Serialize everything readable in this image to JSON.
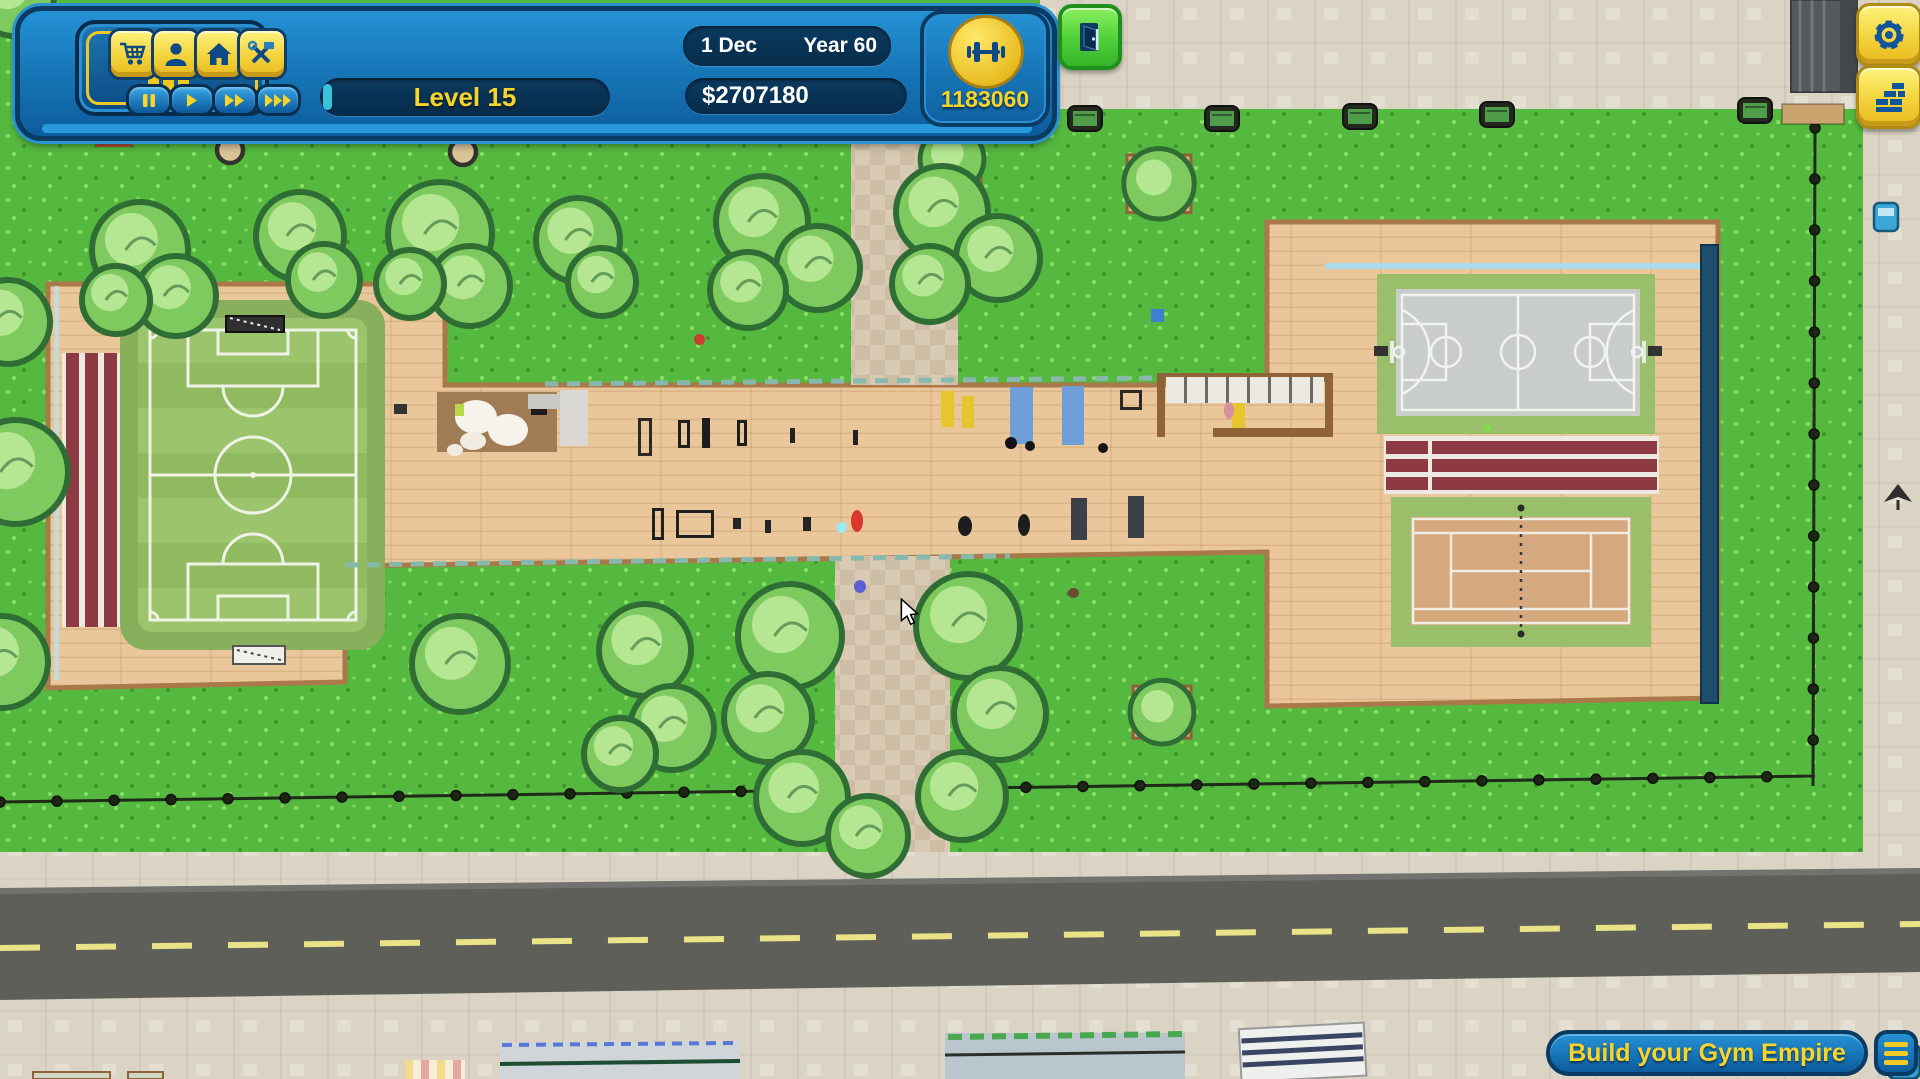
{
  "window": {
    "width": 1920,
    "height": 1079,
    "app": "gym-tycoon-game"
  },
  "colors": {
    "accent_yellow": "#f8d42a",
    "hud_blue": "#1573b4",
    "hud_border": "#0a3c63",
    "grass": "#52b53c",
    "path_tan": "#e9c79a",
    "path_border": "#aa7849",
    "plaza": "#dbd4c4",
    "road": "#5f5f5a",
    "road_line": "#e9e388",
    "field_green": "#9cc46d",
    "court_gray": "#c9cdc9",
    "tennis_clay": "#d6a87e",
    "sport_green": "#9abf6a",
    "track_maroon": "#8e3a42",
    "tree_green": "#7fca5e",
    "tree_outline": "#2f6d35",
    "wall_blue": "#1f4e6e",
    "exit_green": "#4ecf38"
  },
  "hud": {
    "stats_button": {
      "icon": "bar-chart-growth"
    },
    "toolbar": {
      "shop": {
        "icon": "shopping-cart"
      },
      "members": {
        "icon": "person"
      },
      "home": {
        "icon": "home"
      },
      "build": {
        "icon": "hammer-wrench"
      }
    },
    "speed": {
      "pause": {
        "icon": "pause"
      },
      "play": {
        "icon": "play"
      },
      "fast": {
        "icon": "fast-forward-2"
      },
      "fastest": {
        "icon": "fast-forward-3"
      }
    },
    "rating": {
      "stars": 5,
      "max": 5
    },
    "level": {
      "label": "Level 15"
    },
    "calendar": {
      "day": "1 Dec",
      "year": "Year 60"
    },
    "money": {
      "balance": "$2707180"
    },
    "gym_points": {
      "icon": "dumbbell",
      "value": "1183060"
    },
    "exit_button": {
      "icon": "open-door"
    },
    "settings_button": {
      "icon": "gear"
    },
    "walls_button": {
      "icon": "brick-wall"
    },
    "footer": {
      "title": "Build your Gym Empire",
      "menu": {
        "icon": "hamburger-menu"
      }
    }
  },
  "scene": {
    "facilities": [
      "soccer field",
      "running track",
      "outdoor gym strip",
      "spa room",
      "basketball court",
      "bleachers",
      "tennis court",
      "park paths",
      "perimeter fence",
      "road"
    ],
    "trees": [
      [
        14,
        -4,
        40
      ],
      [
        140,
        250,
        48
      ],
      [
        176,
        296,
        40
      ],
      [
        116,
        300,
        34
      ],
      [
        300,
        236,
        44
      ],
      [
        324,
        280,
        36
      ],
      [
        440,
        234,
        52
      ],
      [
        470,
        286,
        40
      ],
      [
        410,
        284,
        34
      ],
      [
        578,
        240,
        42
      ],
      [
        602,
        282,
        34
      ],
      [
        762,
        222,
        46
      ],
      [
        818,
        268,
        42
      ],
      [
        748,
        290,
        38
      ],
      [
        942,
        212,
        46
      ],
      [
        998,
        258,
        42
      ],
      [
        930,
        284,
        38
      ],
      [
        8,
        322,
        42
      ],
      [
        16,
        472,
        52
      ],
      [
        2,
        662,
        46
      ],
      [
        460,
        664,
        48
      ],
      [
        645,
        650,
        46
      ],
      [
        672,
        728,
        42
      ],
      [
        620,
        754,
        36
      ],
      [
        790,
        636,
        52
      ],
      [
        768,
        718,
        44
      ],
      [
        802,
        798,
        46
      ],
      [
        968,
        626,
        52
      ],
      [
        1000,
        714,
        46
      ],
      [
        962,
        796,
        44
      ],
      [
        868,
        836,
        40
      ]
    ],
    "planter_trees": [
      [
        1127,
        155,
        64
      ],
      [
        923,
        133,
        58
      ],
      [
        1133,
        686,
        58
      ]
    ],
    "park_benches": [
      [
        1068,
        106
      ],
      [
        1205,
        106
      ],
      [
        1343,
        104
      ],
      [
        1480,
        102
      ],
      [
        1738,
        98
      ]
    ],
    "wells": [
      [
        230,
        150
      ],
      [
        463,
        152
      ]
    ],
    "gym_equipment": [
      {
        "name": "spa-floor",
        "x": 437,
        "y": 392,
        "w": 120,
        "h": 60,
        "color": "#a07c55"
      },
      {
        "name": "spa-steam-1",
        "x": 455,
        "y": 400,
        "w": 42,
        "h": 34,
        "color": "#f6f3ec",
        "shape": "blob"
      },
      {
        "name": "spa-steam-2",
        "x": 488,
        "y": 414,
        "w": 40,
        "h": 32,
        "color": "#f6f3ec",
        "shape": "blob"
      },
      {
        "name": "spa-steam-3",
        "x": 460,
        "y": 432,
        "w": 26,
        "h": 18,
        "color": "#f0ece1",
        "shape": "blob"
      },
      {
        "name": "spa-steam-4",
        "x": 447,
        "y": 444,
        "w": 16,
        "h": 12,
        "color": "#f0ece1",
        "shape": "blob"
      },
      {
        "name": "spa-item",
        "x": 531,
        "y": 402,
        "w": 16,
        "h": 13,
        "color": "#1c1c1c"
      },
      {
        "name": "spa-plant",
        "x": 455,
        "y": 404,
        "w": 9,
        "h": 12,
        "color": "#b8d84a"
      },
      {
        "name": "gray-mat",
        "x": 528,
        "y": 394,
        "w": 34,
        "h": 15,
        "color": "#c9c9c4"
      },
      {
        "name": "gray-wall",
        "x": 560,
        "y": 390,
        "w": 28,
        "h": 56,
        "color": "#d9d8d3"
      },
      {
        "name": "wall-ladder",
        "x": 638,
        "y": 418,
        "w": 14,
        "h": 38,
        "color": "#2c2824",
        "hollow": true
      },
      {
        "name": "squat-rack-1",
        "x": 678,
        "y": 420,
        "w": 12,
        "h": 28,
        "color": "#1d1d1d",
        "hollow": true
      },
      {
        "name": "squat-rack-2",
        "x": 702,
        "y": 418,
        "w": 8,
        "h": 30,
        "color": "#1d1d1d"
      },
      {
        "name": "squat-rack-3",
        "x": 737,
        "y": 420,
        "w": 10,
        "h": 26,
        "color": "#1d1d1d",
        "hollow": true
      },
      {
        "name": "post-1",
        "x": 790,
        "y": 428,
        "w": 5,
        "h": 15,
        "color": "#222222"
      },
      {
        "name": "post-2",
        "x": 853,
        "y": 430,
        "w": 5,
        "h": 15,
        "color": "#222222"
      },
      {
        "name": "red-ball",
        "x": 694,
        "y": 334,
        "w": 11,
        "h": 11,
        "color": "#cc3b2f",
        "shape": "blob"
      },
      {
        "name": "blue-box",
        "x": 1151,
        "y": 309,
        "w": 13,
        "h": 13,
        "color": "#3f7fd0"
      },
      {
        "name": "yellow-mat-1",
        "x": 941,
        "y": 391,
        "w": 13,
        "h": 36,
        "color": "#e6c52f"
      },
      {
        "name": "yellow-mat-2",
        "x": 962,
        "y": 396,
        "w": 12,
        "h": 32,
        "color": "#e6c52f"
      },
      {
        "name": "yellow-mat-3",
        "x": 1232,
        "y": 388,
        "w": 13,
        "h": 42,
        "color": "#e6c52f"
      },
      {
        "name": "blue-mat-1",
        "x": 1010,
        "y": 387,
        "w": 23,
        "h": 57,
        "color": "#6f9fd8"
      },
      {
        "name": "blue-mat-2",
        "x": 1062,
        "y": 386,
        "w": 22,
        "h": 59,
        "color": "#6f9fd8"
      },
      {
        "name": "swing-frame",
        "x": 1120,
        "y": 390,
        "w": 22,
        "h": 20,
        "color": "#2c2824",
        "hollow": true
      },
      {
        "name": "room-frame-top",
        "x": 1157,
        "y": 373,
        "w": 176,
        "h": 9,
        "color": "#8f6238"
      },
      {
        "name": "room-frame-left",
        "x": 1157,
        "y": 373,
        "w": 8,
        "h": 64,
        "color": "#8f6238"
      },
      {
        "name": "room-frame-right",
        "x": 1325,
        "y": 373,
        "w": 8,
        "h": 64,
        "color": "#8f6238"
      },
      {
        "name": "room-frame-bottom",
        "x": 1213,
        "y": 428,
        "w": 120,
        "h": 9,
        "color": "#8f6238"
      },
      {
        "name": "mirror-wall",
        "x": 1166,
        "y": 377,
        "w": 158,
        "h": 26,
        "color": "#ebe9e2",
        "stripes": true
      },
      {
        "name": "pullup-bar-1",
        "x": 652,
        "y": 508,
        "w": 12,
        "h": 32,
        "color": "#20201c",
        "hollow": true
      },
      {
        "name": "pullup-bar-2",
        "x": 676,
        "y": 510,
        "w": 38,
        "h": 28,
        "color": "#20201c",
        "hollow": true
      },
      {
        "name": "dumbbell-1",
        "x": 733,
        "y": 518,
        "w": 8,
        "h": 11,
        "color": "#242424"
      },
      {
        "name": "dumbbell-2",
        "x": 765,
        "y": 520,
        "w": 6,
        "h": 13,
        "color": "#242424"
      },
      {
        "name": "dumbbell-3",
        "x": 803,
        "y": 517,
        "w": 8,
        "h": 14,
        "color": "#242424"
      },
      {
        "name": "cyan-ball",
        "x": 836,
        "y": 522,
        "w": 11,
        "h": 11,
        "color": "#9fe8ef",
        "shape": "blob"
      },
      {
        "name": "trainer-red",
        "x": 851,
        "y": 510,
        "w": 12,
        "h": 22,
        "color": "#d8372a",
        "shape": "blob"
      },
      {
        "name": "kettlebell-1",
        "x": 958,
        "y": 516,
        "w": 14,
        "h": 20,
        "color": "#1d1d1d",
        "shape": "blob"
      },
      {
        "name": "kettlebell-2",
        "x": 1018,
        "y": 514,
        "w": 12,
        "h": 22,
        "color": "#1d1d1d",
        "shape": "blob"
      },
      {
        "name": "machine-1",
        "x": 1071,
        "y": 498,
        "w": 16,
        "h": 42,
        "color": "#3c4148"
      },
      {
        "name": "machine-2",
        "x": 1128,
        "y": 496,
        "w": 16,
        "h": 42,
        "color": "#3c4148"
      },
      {
        "name": "member-1",
        "x": 1025,
        "y": 441,
        "w": 10,
        "h": 10,
        "color": "#141414",
        "shape": "blob"
      },
      {
        "name": "member-2",
        "x": 1098,
        "y": 443,
        "w": 10,
        "h": 10,
        "color": "#141414",
        "shape": "blob"
      },
      {
        "name": "member-3",
        "x": 1005,
        "y": 437,
        "w": 12,
        "h": 12,
        "color": "#101010",
        "shape": "blob"
      },
      {
        "name": "member-pink",
        "x": 1224,
        "y": 402,
        "w": 10,
        "h": 17,
        "color": "#d9909e",
        "shape": "blob"
      },
      {
        "name": "member-blue",
        "x": 854,
        "y": 580,
        "w": 12,
        "h": 13,
        "color": "#5a5fd0",
        "shape": "blob"
      },
      {
        "name": "member-brown",
        "x": 1068,
        "y": 588,
        "w": 11,
        "h": 10,
        "color": "#6b4a2f",
        "shape": "blob"
      },
      {
        "name": "crate",
        "x": 394,
        "y": 404,
        "w": 13,
        "h": 10,
        "color": "#333333"
      },
      {
        "name": "bench-red",
        "x": 96,
        "y": 140,
        "w": 36,
        "h": 7,
        "color": "#b14a36"
      }
    ],
    "cursor": {
      "x": 898,
      "y": 598
    }
  }
}
